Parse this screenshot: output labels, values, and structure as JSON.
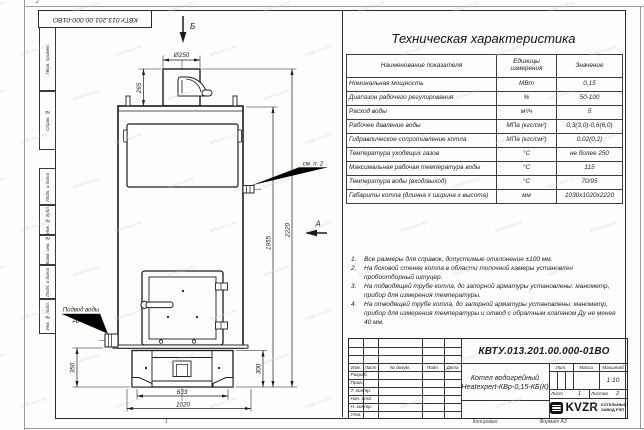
{
  "sheet": {
    "doc_number_rotated": "КВТУ.013.201.00.000-01ВО",
    "zone_top": "2",
    "zone_bottom": "1",
    "copied_label": "Копировал",
    "format_label": "Формат А3"
  },
  "margin_column": {
    "cells": [
      "Перв. примен.",
      "Справ. №",
      "Подп. и дата",
      "Инв. № дубл.",
      "Взам. инв. №",
      "Подп. и дата",
      "Инв. № подл."
    ]
  },
  "watermark": {
    "text": "kotel-kvzr.kz"
  },
  "drawing": {
    "view_labels": {
      "top": "Б",
      "side": "А"
    },
    "dims": {
      "chimney_d": "Ø250",
      "chimney_h": "265",
      "total_h": "2220",
      "body_h": "1955",
      "base_h_left": "350",
      "base_h_right": "300",
      "feet_w": "633",
      "total_w": "1020"
    },
    "callouts": {
      "see_note": "см. п. 2",
      "water_line1": "Подвод воды",
      "water_line2": "Ду 50"
    }
  },
  "tech_table": {
    "title": "Техническая характеристика",
    "headers": [
      "Наименование показателя",
      "Единицы измерения",
      "Значение"
    ],
    "rows": [
      [
        "Номинальная мощность",
        "МВт",
        "0,15"
      ],
      [
        "Диапазон рабочего регулирования",
        "%",
        "50-100"
      ],
      [
        "Расход воды",
        "м³/ч",
        "5"
      ],
      [
        "Рабочее давление воды",
        "МПа (кгс/см²)",
        "0,3(3,0)-0,6(6,0)"
      ],
      [
        "Гидравлическое сопротивление котла",
        "МПа (кгс/см²)",
        "0,02(0,2)"
      ],
      [
        "Температура уходящих газов",
        "°С",
        "не более 250"
      ],
      [
        "Максимальная рабочая температура воды",
        "°С",
        "115"
      ],
      [
        "Температура воды (вход/выход)",
        "°С",
        "70/95"
      ],
      [
        "Габариты котла (длинна х ширина х высота)",
        "мм",
        "1030х1020х2220"
      ]
    ]
  },
  "notes": {
    "items": [
      "Все размеры для справок, допустимые отклонение ±100 мм.",
      "На боковой стенке котла в области топочной камеры установлен пробоотборный штуцер.",
      "На подводящей трубе котла, до запорной арматуры установлены: манометр, прибор для измерения температуры.",
      "На отводящей трубе котла, до запорной арматуры установлены: манометр, прибор для измерения температуры и отвод с обратным клапаном Ду не менее 40 мм."
    ]
  },
  "title_block": {
    "doc_number": "КВТУ.013.201.00.000-01ВО",
    "product_name_line1": "Котел водогрейный",
    "product_name_line2": "Heatexpert-КВр-0,15-КБ(К)",
    "rev_headers": [
      "Изм.",
      "Лист",
      "№ докум.",
      "Подп.",
      "Дата"
    ],
    "role_rows": [
      "Разраб.",
      "Пров.",
      "Т. контр.",
      "Нач. отд.",
      "Н. контр.",
      "Утв."
    ],
    "lit_label": "Лит.",
    "mass_label": "Масса",
    "scale_label": "Масштаб",
    "scale_value": "1:10",
    "sheet_label": "Лист",
    "sheet_value": "1",
    "sheets_label": "Листов",
    "sheets_value": "2",
    "logo_text": "KVZR",
    "company_line1": "КОТЕЛЬНЫЙ",
    "company_line2": "ЗАВОД РЭП"
  }
}
